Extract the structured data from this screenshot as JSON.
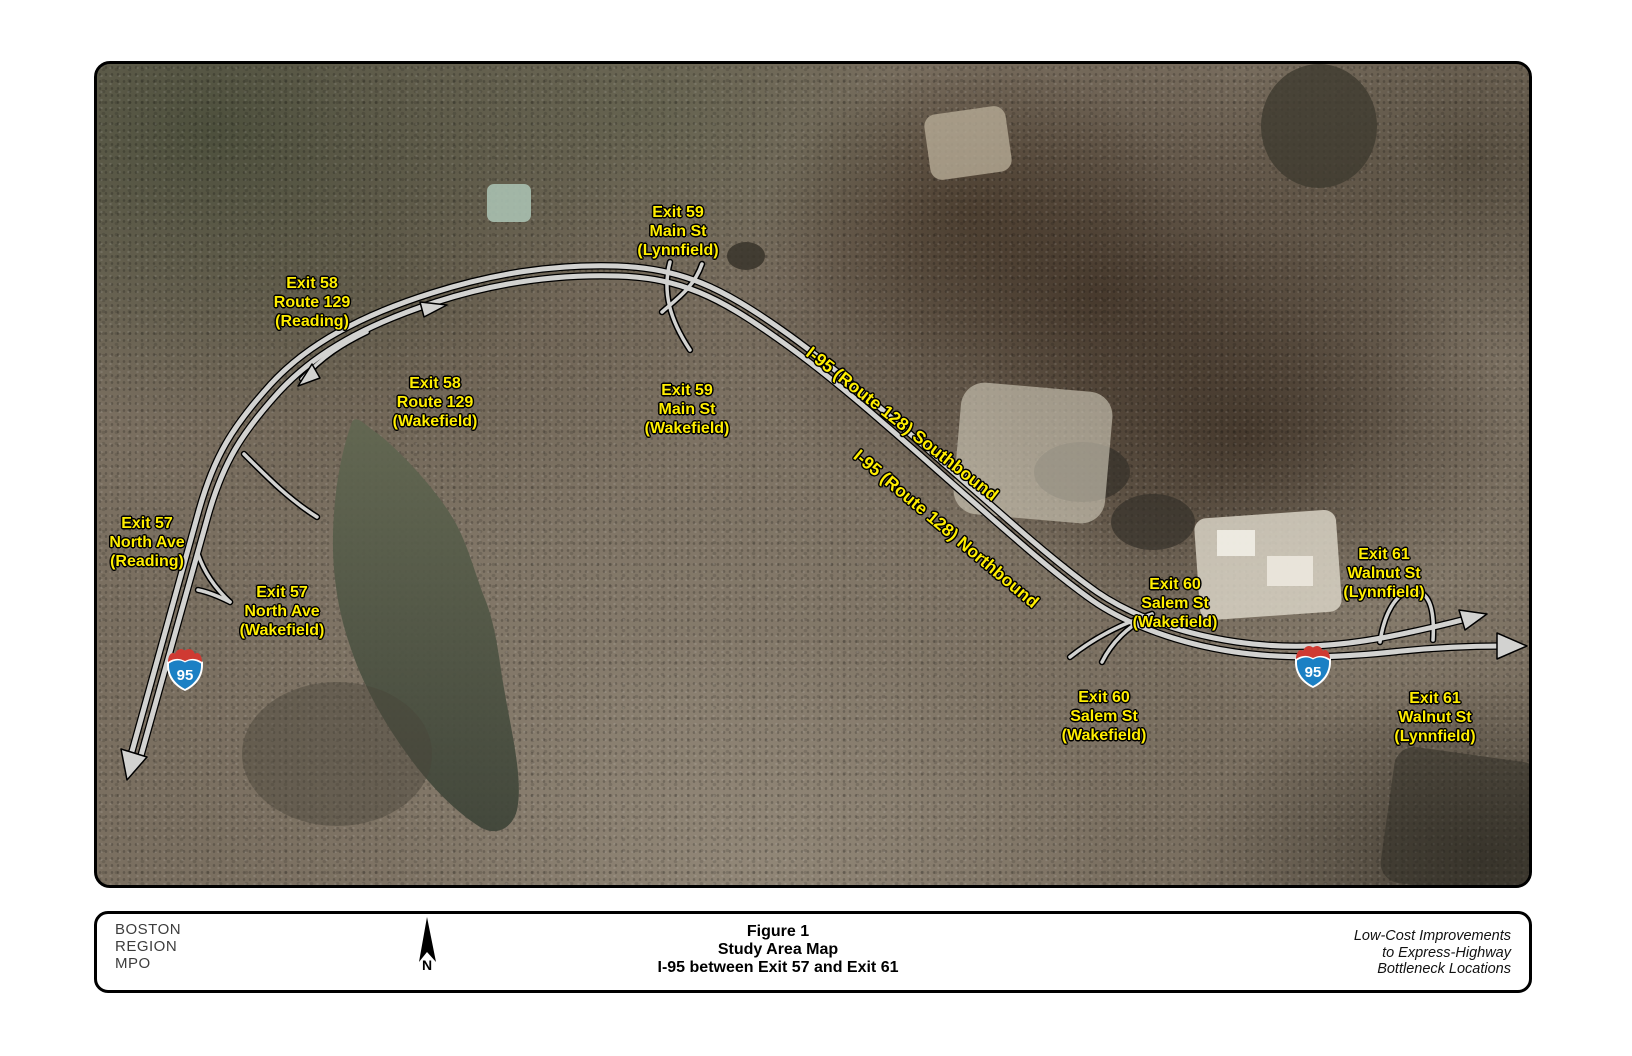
{
  "figure": {
    "exit_labels": [
      {
        "line1": "Exit 59",
        "line2": "Main St",
        "line3": "(Lynnfield)"
      },
      {
        "line1": "Exit 58",
        "line2": "Route 129",
        "line3": "(Reading)"
      },
      {
        "line1": "Exit 58",
        "line2": "Route 129",
        "line3": "(Wakefield)"
      },
      {
        "line1": "Exit 59",
        "line2": "Main St",
        "line3": "(Wakefield)"
      },
      {
        "line1": "Exit 57",
        "line2": "North Ave",
        "line3": "(Reading)"
      },
      {
        "line1": "Exit 57",
        "line2": "North Ave",
        "line3": "(Wakefield)"
      },
      {
        "line1": "Exit 60",
        "line2": "Salem St",
        "line3": "(Wakefield)"
      },
      {
        "line1": "Exit 61",
        "line2": "Walnut St",
        "line3": "(Lynnfield)"
      },
      {
        "line1": "Exit 60",
        "line2": "Salem St",
        "line3": "(Wakefield)"
      },
      {
        "line1": "Exit 61",
        "line2": "Walnut St",
        "line3": "(Lynnfield)"
      }
    ],
    "route_labels": {
      "southbound": "I-95 (Route 128) Southbound",
      "northbound": "I-95 (Route 128) Northbound"
    },
    "shield_number": "95"
  },
  "footer": {
    "org": [
      "BOSTON",
      "REGION",
      "MPO"
    ],
    "north_label": "N",
    "title": [
      "Figure 1",
      "Study Area Map",
      "I-95 between Exit 57 and Exit 61"
    ],
    "note": [
      "Low-Cost Improvements",
      "to Express-Highway",
      "Bottleneck Locations"
    ]
  },
  "colors": {
    "label_yellow": "#ffee00",
    "road_fill": "#d2d2d0",
    "road_casing": "#000000",
    "shield_blue": "#1b80c4",
    "shield_red": "#cf3a32",
    "water": "#565c4d"
  }
}
